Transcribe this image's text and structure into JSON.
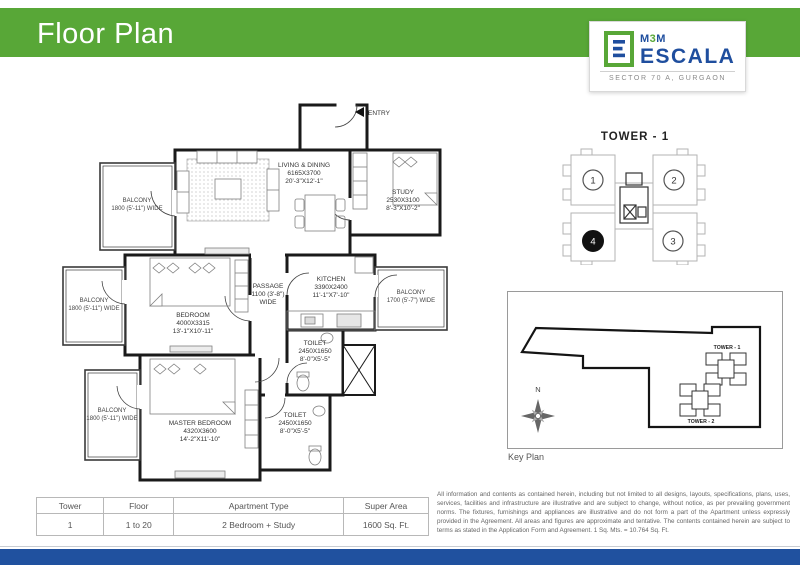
{
  "page": {
    "title": "Floor Plan"
  },
  "logo": {
    "brand_parts": [
      "M",
      "3",
      "M"
    ],
    "brand_main": "ESCALA",
    "tagline": "SECTOR 70 A, GURGAON"
  },
  "plan": {
    "entry": "ENTRY",
    "living": {
      "name": "LIVING & DINING",
      "mm": "6165X3700",
      "ft": "20'-3\"X12'-1\""
    },
    "study": {
      "name": "STUDY",
      "mm": "2530X3100",
      "ft": "8'-3\"X10'-2\""
    },
    "bedroom": {
      "name": "BEDROOM",
      "mm": "4000X3315",
      "ft": "13'-1\"X10'-11\""
    },
    "master_bedroom": {
      "name": "MASTER BEDROOM",
      "mm": "4320X3600",
      "ft": "14'-2\"X11'-10\""
    },
    "kitchen": {
      "name": "KITCHEN",
      "mm": "3390X2400",
      "ft": "11'-1\"X7'-10\""
    },
    "passage": {
      "name": "PASSAGE",
      "line2": "1100 (3'-8\")",
      "line3": "WIDE"
    },
    "toilet1": {
      "name": "TOILET",
      "mm": "2450X1650",
      "ft": "8'-0\"X5'-5\""
    },
    "toilet2": {
      "name": "TOILET",
      "mm": "2450X1650",
      "ft": "8'-0\"X5'-5\""
    },
    "balcony_top_left": {
      "name": "BALCONY",
      "line2": "1800 (5'-11\") WIDE"
    },
    "balcony_mid_left": {
      "name": "BALCONY",
      "line2": "1800 (5'-11\") WIDE"
    },
    "balcony_bottom_left": {
      "name": "BALCONY",
      "line2": "1800 (5'-11\") WIDE"
    },
    "balcony_right": {
      "name": "BALCONY",
      "line2": "1700 (5'-7\") WIDE"
    }
  },
  "tower_diagram": {
    "title": "TOWER - 1",
    "unit1": "1",
    "unit2": "2",
    "unit3": "3",
    "unit4": "4",
    "highlighted_unit": "4"
  },
  "key_plan": {
    "caption": "Key Plan",
    "north": "N",
    "tower1": "TOWER - 1",
    "tower2": "TOWER - 2"
  },
  "table": {
    "headers": [
      "Tower",
      "Floor",
      "Apartment Type",
      "Super Area"
    ],
    "row": [
      "1",
      "1 to 20",
      "2 Bedroom + Study",
      "1600 Sq. Ft."
    ]
  },
  "disclaimer": "All information and contents as contained herein, including but not limited to all designs, layouts, specifications, plans, uses, services, facilities and infrastructure are illustrative and are subject to change, without notice, as per prevailing government norms. The fixtures, furnishings and appliances are illustrative and do not form a part of the Apartment unless expressly provided in the Agreement. All areas and figures are approximate and tentative. The contents contained herein are subject to terms as stated in the Application Form and Agreement. 1 Sq. Mts. = 10.764 Sq. Ft.",
  "colors": {
    "header_green": "#58a737",
    "brand_blue": "#1f4e9e",
    "footer_blue": "#20519f"
  }
}
